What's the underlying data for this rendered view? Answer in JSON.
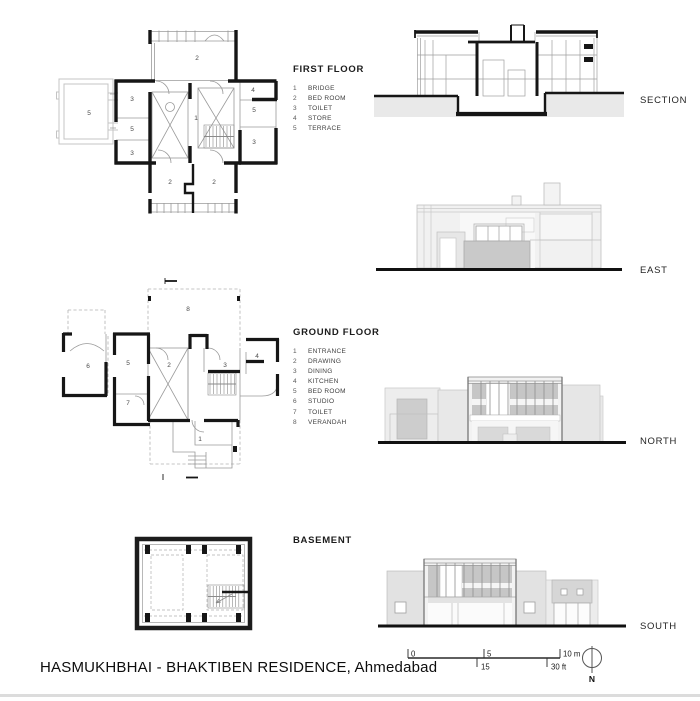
{
  "page": {
    "title": "HASMUKHBHAI - BHAKTIBEN RESIDENCE, Ahmedabad"
  },
  "plans": {
    "first_floor": {
      "label": "FIRST FLOOR",
      "legend": [
        {
          "num": "1",
          "name": "BRIDGE"
        },
        {
          "num": "2",
          "name": "BED ROOM"
        },
        {
          "num": "3",
          "name": "TOILET"
        },
        {
          "num": "4",
          "name": "STORE"
        },
        {
          "num": "5",
          "name": "TERRACE"
        }
      ],
      "room_numbers": {
        "bridge": "1",
        "bed_room": "2",
        "toilet": "3",
        "store": "4",
        "terrace": "5"
      }
    },
    "ground_floor": {
      "label": "GROUND FLOOR",
      "legend": [
        {
          "num": "1",
          "name": "ENTRANCE"
        },
        {
          "num": "2",
          "name": "DRAWING"
        },
        {
          "num": "3",
          "name": "DINING"
        },
        {
          "num": "4",
          "name": "KITCHEN"
        },
        {
          "num": "5",
          "name": "BED ROOM"
        },
        {
          "num": "6",
          "name": "STUDIO"
        },
        {
          "num": "7",
          "name": "TOILET"
        },
        {
          "num": "8",
          "name": "VERANDAH"
        }
      ],
      "room_numbers": {
        "entrance": "1",
        "drawing": "2",
        "dining": "3",
        "kitchen": "4",
        "bed_room": "5",
        "studio": "6",
        "toilet": "7",
        "verandah": "8"
      }
    },
    "basement": {
      "label": "BASEMENT"
    }
  },
  "elevations": {
    "section": "SECTION",
    "east": "EAST",
    "north": "NORTH",
    "south": "SOUTH"
  },
  "scale_bar": {
    "m0": "0",
    "m5": "5",
    "m10": "10 m",
    "ft15": "15",
    "ft30": "30 ft"
  },
  "north_arrow": {
    "label": "N"
  },
  "colors": {
    "wall": "#161616",
    "thin_line": "#9a9a9a",
    "terrace_line": "#c4c4c4",
    "light_fill": "#efefef",
    "mid_fill": "#c9c9c9",
    "ground_fill": "#e9e9e9",
    "footer_bar": "#dcdcdc"
  }
}
